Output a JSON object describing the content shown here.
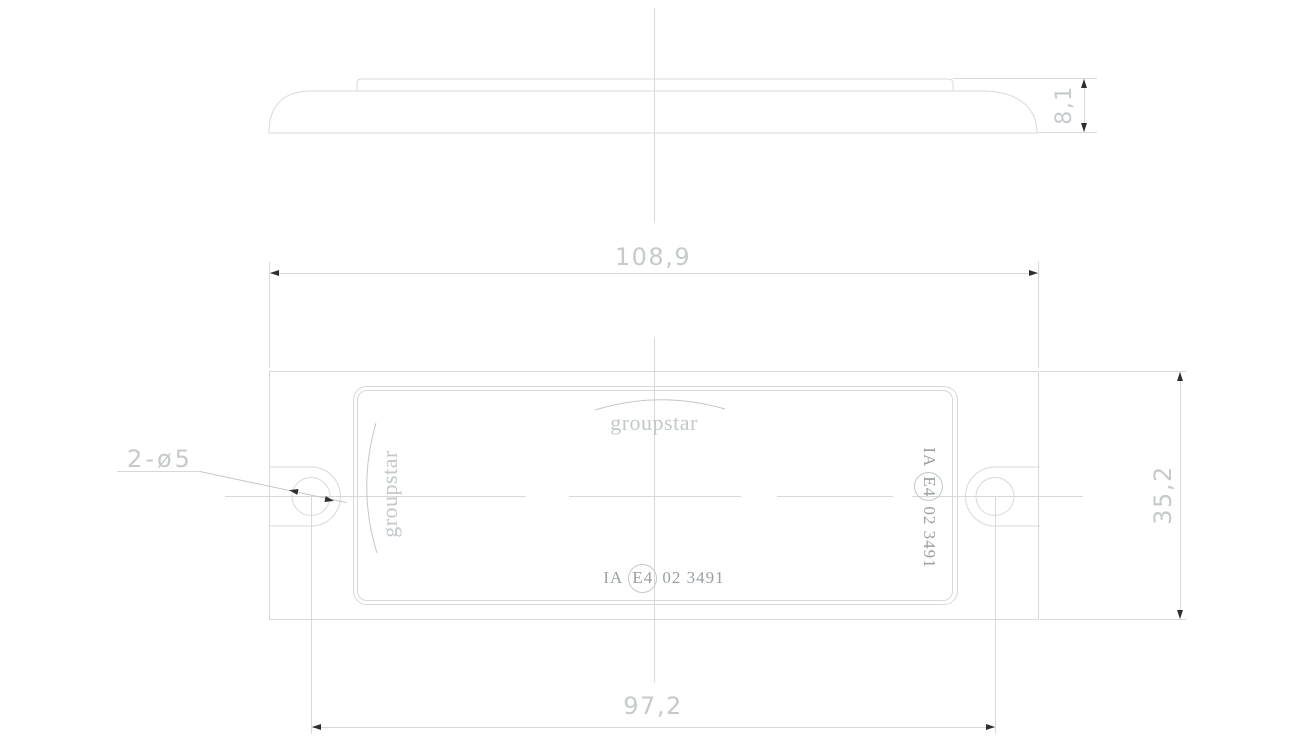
{
  "drawing": {
    "type": "technical-drawing",
    "views": [
      "side-profile",
      "front-face"
    ]
  },
  "colors": {
    "line": "#d8d8d8",
    "dim": "#c6cacc",
    "marking": "#9aa0a3",
    "logo": "#c3c8ca",
    "arrow": "#2f2f2f"
  },
  "dimensions": {
    "total_width": "108,9",
    "hole_spacing": "97,2",
    "total_height": "35,2",
    "thickness": "8,1",
    "holes_callout": "2-ø5"
  },
  "logo": {
    "text": "groupstar"
  },
  "marking": {
    "prefix": "IA",
    "e_mark": "E4",
    "suffix": "02 3491"
  }
}
